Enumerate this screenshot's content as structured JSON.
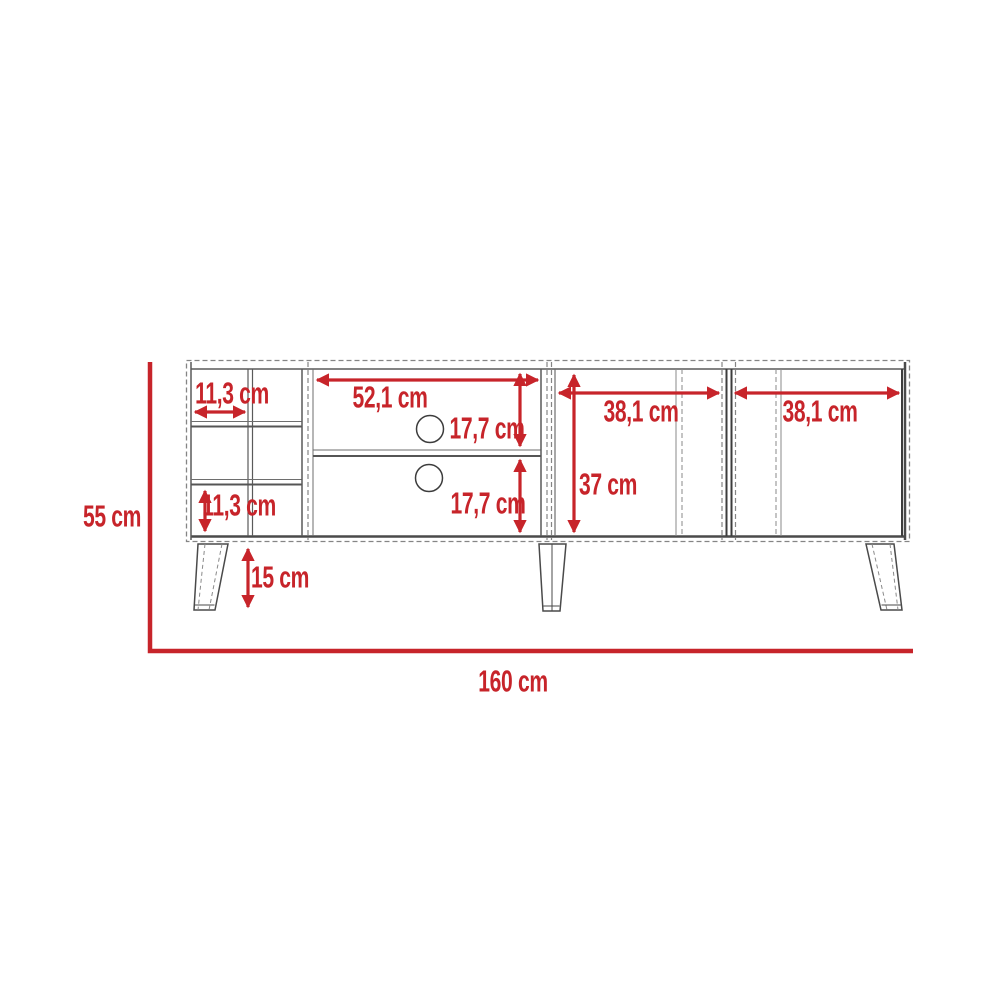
{
  "diagram": {
    "type": "furniture-dimension-drawing",
    "subject": "TV stand front elevation with red dimension annotations",
    "units": "cm",
    "colors": {
      "dimension_red": "#c7242a",
      "outline_gray": "#4a4a4a",
      "dashed_gray": "#858585"
    },
    "labels": {
      "cubby_width": "11,3 cm",
      "cubby_height": "11,3 cm",
      "center_width": "52,1 cm",
      "center_upper_height": "17,7 cm",
      "center_lower_height": "17,7 cm",
      "left_door_width": "38,1 cm",
      "right_door_width": "38,1 cm",
      "door_height": "37 cm",
      "leg_height": "15 cm",
      "total_height": "55 cm",
      "total_width": "160 cm"
    }
  }
}
